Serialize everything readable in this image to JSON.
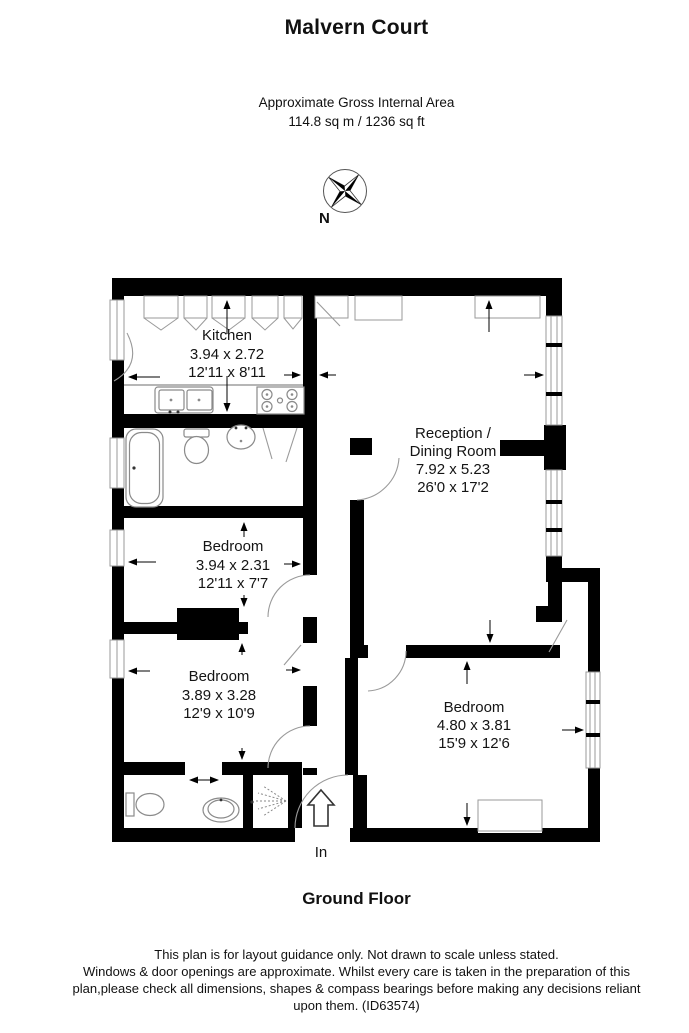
{
  "header": {
    "title": "Malvern Court",
    "area_label": "Approximate Gross Internal Area",
    "area_value": "114.8 sq m / 1236 sq ft"
  },
  "compass": {
    "north_label": "N"
  },
  "rooms": {
    "kitchen": {
      "name": "Kitchen",
      "metric": "3.94 x 2.72",
      "imperial": "12'11 x 8'11"
    },
    "reception": {
      "name1": "Reception /",
      "name2": "Dining Room",
      "metric": "7.92 x 5.23",
      "imperial": "26'0 x 17'2"
    },
    "bedroom1": {
      "name": "Bedroom",
      "metric": "3.94 x 2.31",
      "imperial": "12'11 x 7'7"
    },
    "bedroom2": {
      "name": "Bedroom",
      "metric": "3.89 x 3.28",
      "imperial": "12'9 x 10'9"
    },
    "bedroom3": {
      "name": "Bedroom",
      "metric": "4.80 x 3.81",
      "imperial": "15'9 x 12'6"
    }
  },
  "entrance": {
    "label": "In"
  },
  "footer": {
    "floor_label": "Ground Floor",
    "disclaimer_line1": "This plan is for layout guidance only. Not drawn to scale unless stated.",
    "disclaimer_rest": "Windows & door openings are approximate. Whilst every care is taken in the preparation of this plan,please check all dimensions, shapes & compass bearings before making any decisions reliant upon them. (ID63574)"
  },
  "colors": {
    "wall": "#000000",
    "text": "#111111",
    "window_line": "#9a9a9a",
    "fixture_line": "#8a8a8a"
  }
}
